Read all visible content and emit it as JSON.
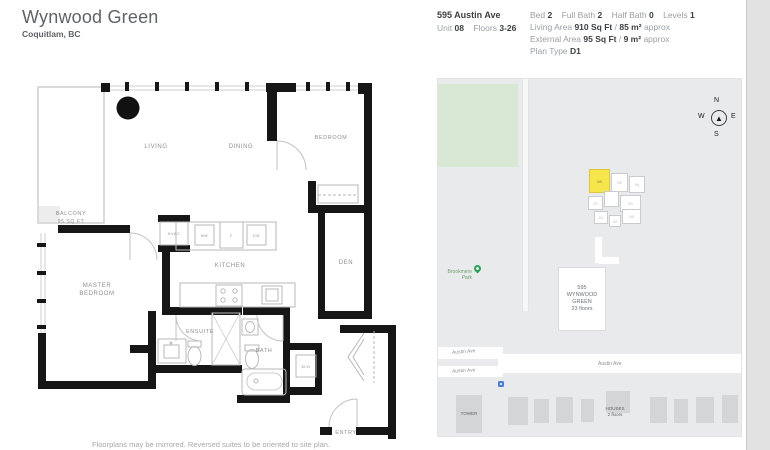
{
  "header": {
    "title": "Wynwood Green",
    "location": "Coquitlam, BC",
    "address": "595 Austin Ave",
    "unit": {
      "label": "Unit",
      "value": "08"
    },
    "floors": {
      "label": "Floors",
      "value": "3-26"
    },
    "specs": [
      {
        "label": "Bed",
        "value": "2"
      },
      {
        "label": "Full Bath",
        "value": "2"
      },
      {
        "label": "Half Bath",
        "value": "0"
      },
      {
        "label": "Levels",
        "value": "1"
      }
    ],
    "living_area": {
      "label": "Living Area",
      "imperial": "910 Sq Ft",
      "separator": "/",
      "metric": "85 m²",
      "suffix": "approx"
    },
    "external_area": {
      "label": "External Area",
      "imperial": "95 Sq Ft",
      "separator": "/",
      "metric": "9 m²",
      "suffix": "approx"
    },
    "plan_type": {
      "label": "Plan Type",
      "value": "D1"
    }
  },
  "floorplan": {
    "rooms": {
      "balcony": "BALCONY",
      "balcony_area": "95 SQ FT",
      "living": "LIVING",
      "dining": "DINING",
      "bedroom": "BEDROOM",
      "den": "DEN",
      "kitchen": "KITCHEN",
      "master_line1": "MASTER",
      "master_line2": "BEDROOM",
      "ensuite": "ENSUITE",
      "bath": "BATH",
      "entry": "ENTRY",
      "hvac": "HVAC",
      "wd": "W/D",
      "mw": "MW",
      "fridge": "F",
      "dw": "DW"
    },
    "disclaimer": "Floorplans may be mirrored. Reversed suites to be oriented to site plan."
  },
  "map": {
    "park_label": "Brookmere Park",
    "compass": {
      "n": "N",
      "e": "E",
      "s": "S",
      "w": "W"
    },
    "building_box": {
      "line1": "595",
      "line2": "WYNWOOD",
      "line3": "GREEN",
      "line4": "23 floors"
    },
    "streets": {
      "austin_upper": "Austin Ave",
      "austin_lower": "Austin Ave",
      "austin_main": "Austin Ave"
    },
    "tower_label": "TOWER",
    "houses": {
      "line1": "HOUSES",
      "line2": "2 floors"
    },
    "units": [
      {
        "label": "08",
        "highlighted": true
      },
      {
        "label": "05",
        "highlighted": false
      },
      {
        "label": "04",
        "highlighted": false
      },
      {
        "label": "07",
        "highlighted": false
      },
      {
        "label": "",
        "highlighted": false
      },
      {
        "label": "03",
        "highlighted": false
      },
      {
        "label": "01",
        "highlighted": false
      },
      {
        "label": "02",
        "highlighted": false
      },
      {
        "label": "06",
        "highlighted": false
      }
    ]
  },
  "colors": {
    "highlight_unit": "#f6e54b",
    "park_green": "#d9e8d4",
    "map_background": "#e8eaec",
    "pin_green": "#2ba05a",
    "wall_black": "#161616"
  }
}
